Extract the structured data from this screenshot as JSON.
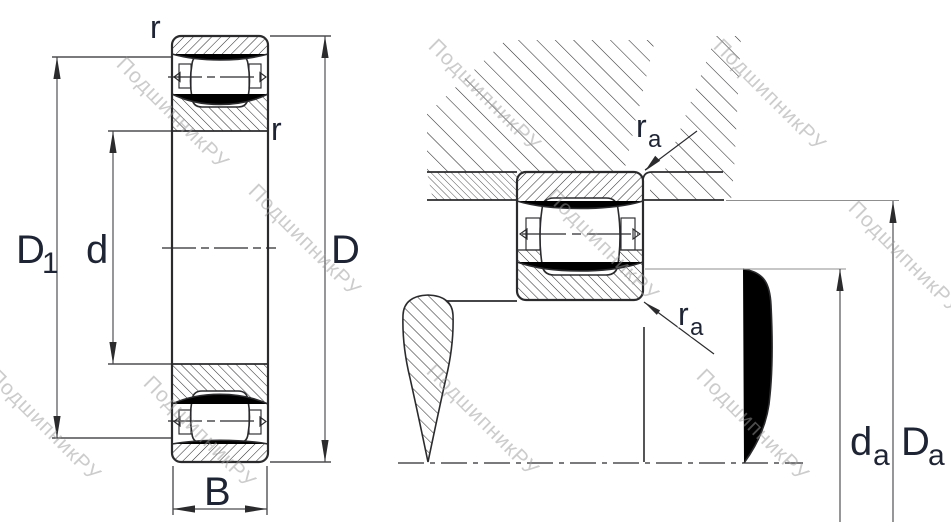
{
  "watermark": {
    "text": "ПодшипникРУ"
  },
  "labels": {
    "outside_diameter": {
      "main": "D"
    },
    "bore_diameter": {
      "main": "d"
    },
    "inner_shoulder_diameter": {
      "main": "D",
      "sub": "1"
    },
    "width": {
      "main": "B"
    },
    "ring_corner_radius": "r",
    "mount_fillet_radius": {
      "main": "r",
      "sub": "a"
    },
    "shaft_abutment_diameter": {
      "main": "d",
      "sub": "a"
    },
    "housing_abutment_diameter": {
      "main": "D",
      "sub": "a"
    }
  },
  "colors": {
    "background": "#ffffff",
    "line": "#2b2b2e",
    "label": "#1e2433",
    "dim": "#4a4a4e",
    "ext": "#8f8f8f",
    "watermark": "#9a9a9a"
  }
}
